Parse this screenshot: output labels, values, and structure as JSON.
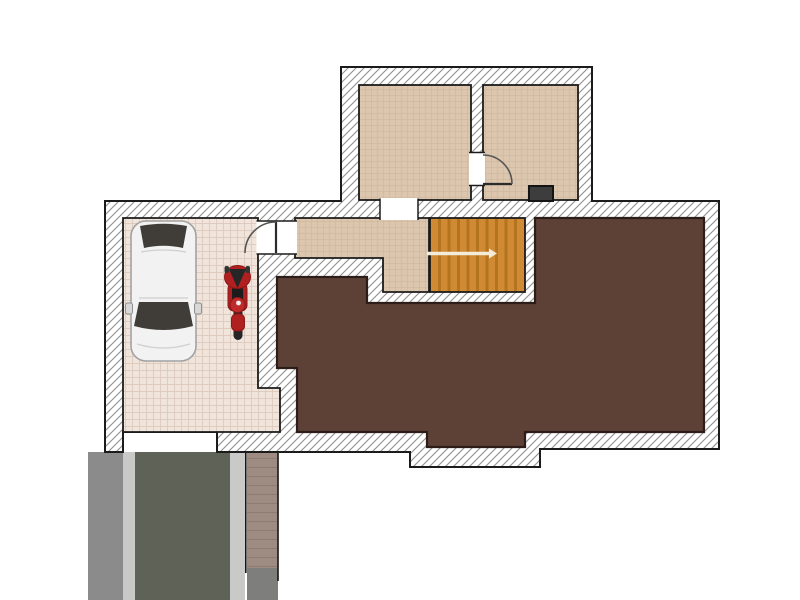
{
  "scene": {
    "type": "architectural-floor-plan",
    "visible_text": [],
    "objects": {
      "rooms": [
        "top-left-room",
        "top-right-room",
        "hallway",
        "staircase",
        "large-unfinished-room",
        "garage"
      ],
      "vehicles": [
        "car",
        "motorcycle"
      ],
      "outdoor": [
        "driveway",
        "brick-walkway"
      ],
      "fixtures": [
        "dark-fixture",
        "interior-door-top",
        "garage-hall-door",
        "garage-door-opening",
        "room-passage-opening"
      ]
    }
  },
  "colors": {
    "background": "#ffffff",
    "wall_fill": "#ffffff",
    "wall_hatch_line": "#8f8f8f",
    "wall_outline": "#1b1b1b",
    "garage_floor": "#f0e4db",
    "garage_grid": "#dcc9bd",
    "room_floor": "#dcc6ad",
    "room_grid": "#cdb79e",
    "stairs_wood": "#cf8a33",
    "stairs_tread": "#b4731f",
    "walkline": "#f2ecd9",
    "large_room": "#5d4036",
    "large_room_outline": "#2c1d19",
    "driveway_side_gray": "#8b8b8b",
    "driveway_curb": "#c9c9c7",
    "driveway_asphalt": "#5f6257",
    "walkway_brick": "#9e8b82",
    "walkway_end_gray": "#7e7e7c",
    "door_arc": "#555555",
    "door_leaf": "#2b2b2b",
    "fixture_dark": "#3d3d3d",
    "car_body": "#f2f2f2",
    "car_window": "#403d39",
    "car_trim": "#a2a2a2",
    "moto_red": "#b02020",
    "moto_dark": "#262626"
  }
}
